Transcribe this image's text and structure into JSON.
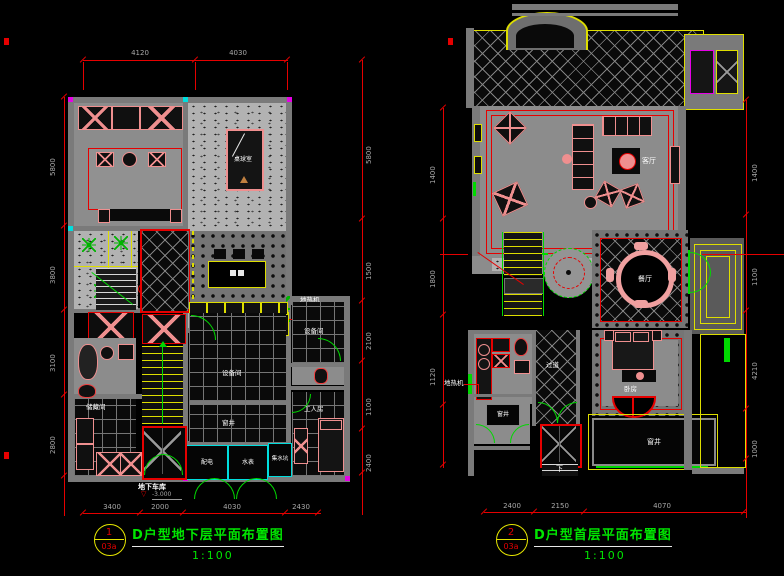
{
  "titles": {
    "left": {
      "num": "1",
      "sheet": "03a",
      "name": "D户型地下层平面布置图",
      "scale": "1:100"
    },
    "right": {
      "num": "2",
      "sheet": "03a",
      "name": "D户型首层平面布置图",
      "scale": "1:100"
    }
  },
  "left_plan": {
    "labels": {
      "pool_room": "桌球室",
      "heater": "地热机",
      "equip_right": "设备间",
      "equip_center": "设备间",
      "window_well": "窗井",
      "power": "配电",
      "water_meter": "水表",
      "sump": "集水坑",
      "worker_room": "工人房",
      "storage": "储藏间",
      "garage": "地下车库",
      "garage_level": "-3.000"
    },
    "dims": {
      "top": [
        "4120",
        "4030"
      ],
      "bottom": [
        "3400",
        "2000",
        "4030",
        "2430"
      ],
      "left": [
        "5800",
        "3800",
        "3100",
        "2800"
      ],
      "right": [
        "5800",
        "1500",
        "2100",
        "1100",
        "2400"
      ]
    }
  },
  "right_plan": {
    "labels": {
      "living": "客厅",
      "dining": "餐厅",
      "hall": "过道",
      "bedroom": "卧房",
      "heater": "地热机",
      "well_left": "窗井",
      "well_bottom": "窗井",
      "down": "下"
    },
    "dims": {
      "bottom": [
        "2400",
        "2150",
        "4070"
      ],
      "left": [
        "1400",
        "1800",
        "1120"
      ],
      "right": [
        "1400",
        "1100",
        "4210",
        "1000"
      ]
    }
  }
}
